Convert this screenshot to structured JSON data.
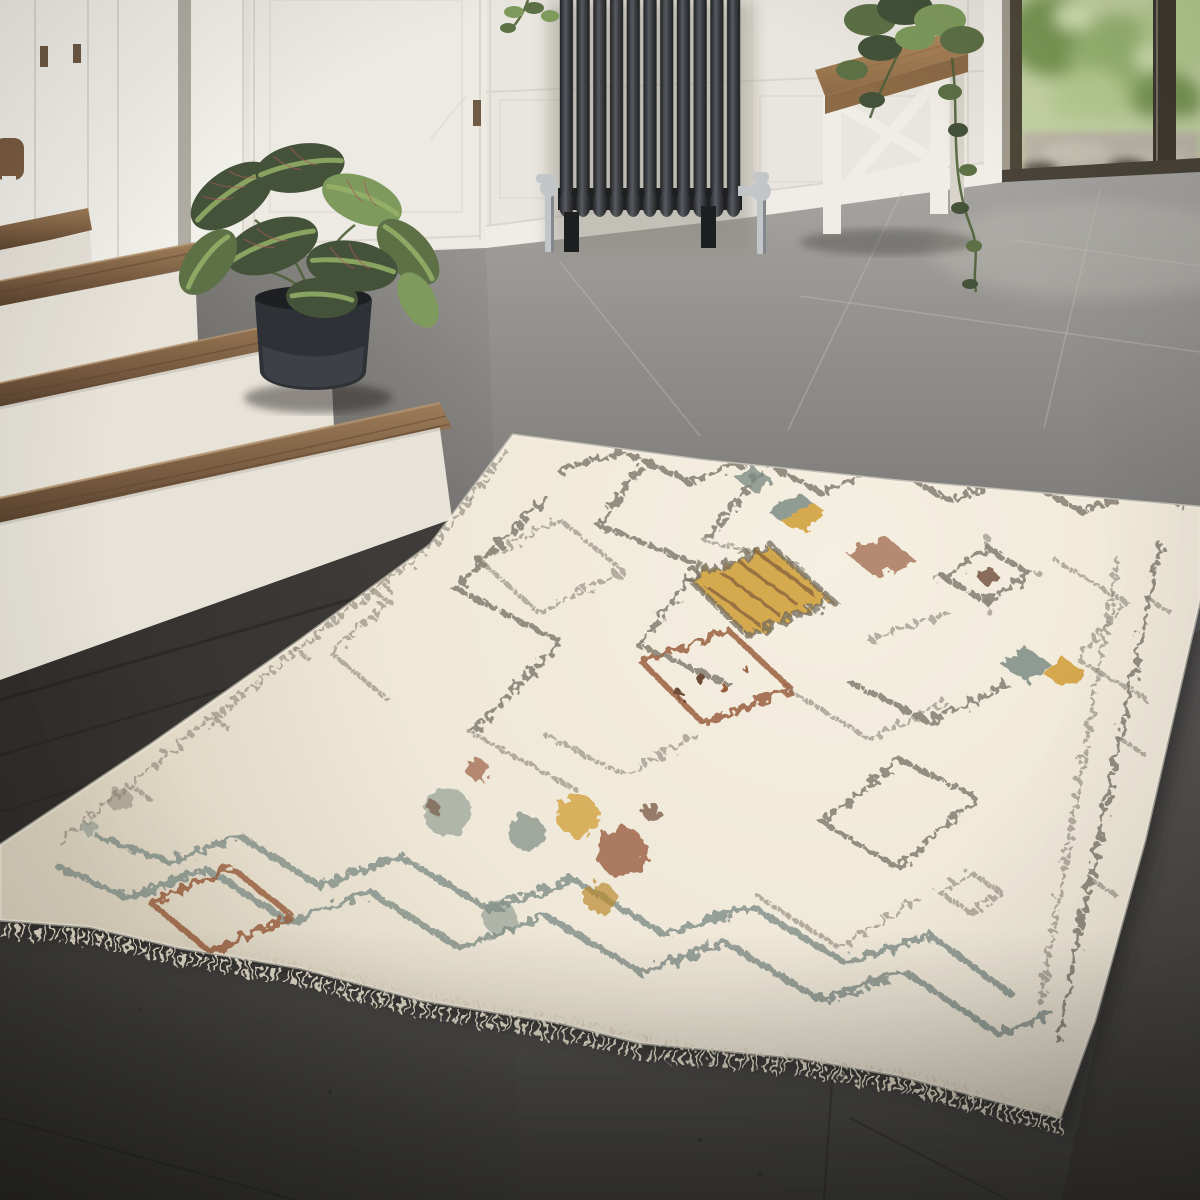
{
  "scene": {
    "type": "interior-photograph",
    "description": "Cream Berber-style shag rug with multicolour geometric diamond pattern, lying on grey concrete tile floor in a bright entryway with white staircase, black column radiator, wooden bench and glass door",
    "width_px": 1200,
    "height_px": 1200
  },
  "objects": [
    {
      "name": "staircase",
      "detail": "white risers with walnut wood treads, wooden handrail fragment at left edge"
    },
    {
      "name": "prayer-plant",
      "detail": "maranta with striped green leaves in dark charcoal pot beside stairs"
    },
    {
      "name": "column-radiator",
      "detail": "black cast-iron 11-column radiator with chrome valves against white panelled wall"
    },
    {
      "name": "entry-bench",
      "detail": "farmhouse bench, walnut seat with white truss legs, trailing green plant on top"
    },
    {
      "name": "glass-door",
      "detail": "dark-framed glass door showing blurred garden greenery and stone patio outside"
    },
    {
      "name": "tile-floor",
      "detail": "large grey concrete tiles, light near window, dark in foreground"
    },
    {
      "name": "berber-rug",
      "detail": "cream shag rug, speckled charcoal diamond lattice, zigzag teal border, mustard / rust / grey-blue accent diamonds, fringed lower edge"
    }
  ],
  "palette": {
    "wall": "#e9e6df",
    "wallHi": "#f2f0ea",
    "wallShadow": "#d6d2c8",
    "slotDark": "#b0aca3",
    "doorFace": "#edeae3",
    "hinge": "#6e5a45",
    "railWood": "#7a5c41",
    "baseboard": "#efede6",
    "frameLight": "#a29b8e",
    "frameDark": "#4e4839",
    "mullion": "#3f3a31",
    "glassSill": "#4a443a",
    "threshold": "#c9c4b9",
    "foliage1": "#7a9a55",
    "foliage2": "#9ab873",
    "foliage3": "#b9cf92",
    "foliageLight": "#d8e5b5",
    "outMid": "#c8d5a6",
    "stoneOut": "#bdb7a9",
    "soilOut": "#5f594e",
    "floor1": "#a7a5a1",
    "floor2": "#8e8c88",
    "floor3": "#727070",
    "floor4": "#585653",
    "floor5": "#434240",
    "groutLight": "#c2bfb8",
    "groutDark": "#2b2927",
    "underStair": "#3d3b37",
    "floorShadow": "#2a2826",
    "radDark": "#1e1f21",
    "radMid": "#3c3e42",
    "radHi": "#585b62",
    "chrome": "#c3c6c9",
    "chromeDark": "#84888c",
    "benchWood": "#b28a5e",
    "benchWoodDark": "#8c6a46",
    "benchGrain": "#97714a",
    "benchLeg": "#efede6",
    "benchLegShade": "#d8d4ca",
    "stairWood": "#7d5f44",
    "stairWoodDark": "#5a432e",
    "stairWoodHi": "#9c7c58",
    "riser": "#e7e3d9",
    "riserShade": "#d2cec3",
    "pot": "#2e3135",
    "potHi": "#4a4f55",
    "potRim": "#1d1f22",
    "leafDark": "#44523a",
    "leafMid": "#5d7046",
    "leafLight": "#7e9a5c",
    "leafStripe": "#95b269",
    "leafVein": "#a85a58",
    "stem": "#4e6039",
    "rugBase": "#efe8d8",
    "rugLightTone": "#f5efe1",
    "rugShade": "#d9d0bc",
    "rugLine": "#6f6a5d",
    "rugLineSoft": "#8a8476",
    "rugTeal": "#7e8c85",
    "rugRust": "#9a5f41",
    "rugBrown": "#6e4c39",
    "rugMustard": "#d2a13f",
    "rugMustardDark": "#b98a2e",
    "fringe": "#e6decb",
    "rugShadow": "#242220"
  }
}
